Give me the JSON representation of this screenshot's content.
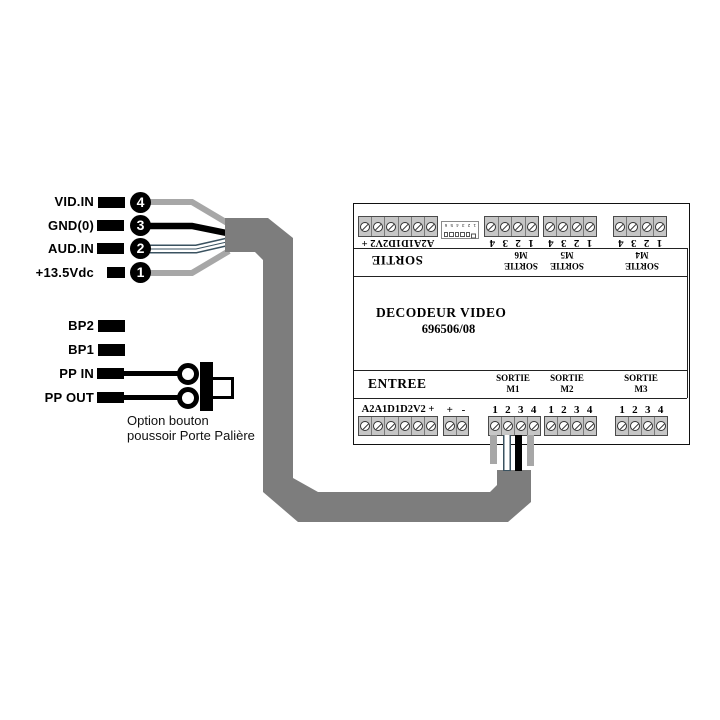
{
  "left": {
    "signal_rows": [
      {
        "label": "VID.IN",
        "num": "4"
      },
      {
        "label": "GND(0)",
        "num": "3"
      },
      {
        "label": "AUD.IN",
        "num": "2"
      },
      {
        "label": "+13.5Vdc",
        "num": "1"
      }
    ],
    "bp_rows": [
      {
        "label": "BP2"
      },
      {
        "label": "BP1"
      },
      {
        "label": "PP IN"
      },
      {
        "label": "PP OUT"
      }
    ],
    "option_caption_line1": "Option bouton",
    "option_caption_line2": "poussoir Porte Palière"
  },
  "decoder": {
    "title_line1": "DECODEUR VIDEO",
    "title_line2": "696506/08",
    "sortie_label": "SORTIE",
    "entree_label": "ENTREE",
    "io_terminal_label": "A2A1D1D2V2 +",
    "plus_minus_label": "+ -",
    "numbers_label": "1 2 3 4",
    "dip_numbers": "1 2 3 4 5 6",
    "outputs_top": [
      {
        "line1": "SORTIE",
        "line2": "M6"
      },
      {
        "line1": "SORTIE",
        "line2": "M5"
      },
      {
        "line1": "SORTIE",
        "line2": "M4"
      }
    ],
    "outputs_bottom": [
      {
        "line1": "SORTIE",
        "line2": "M1"
      },
      {
        "line1": "SORTIE",
        "line2": "M2"
      },
      {
        "line1": "SORTIE",
        "line2": "M3"
      }
    ]
  },
  "colors": {
    "cable": "#7d7d7d",
    "wire_gray": "#a7a7a7",
    "wire_white_outline": "#3a5260",
    "terminal_fill": "#c6c6c6"
  }
}
